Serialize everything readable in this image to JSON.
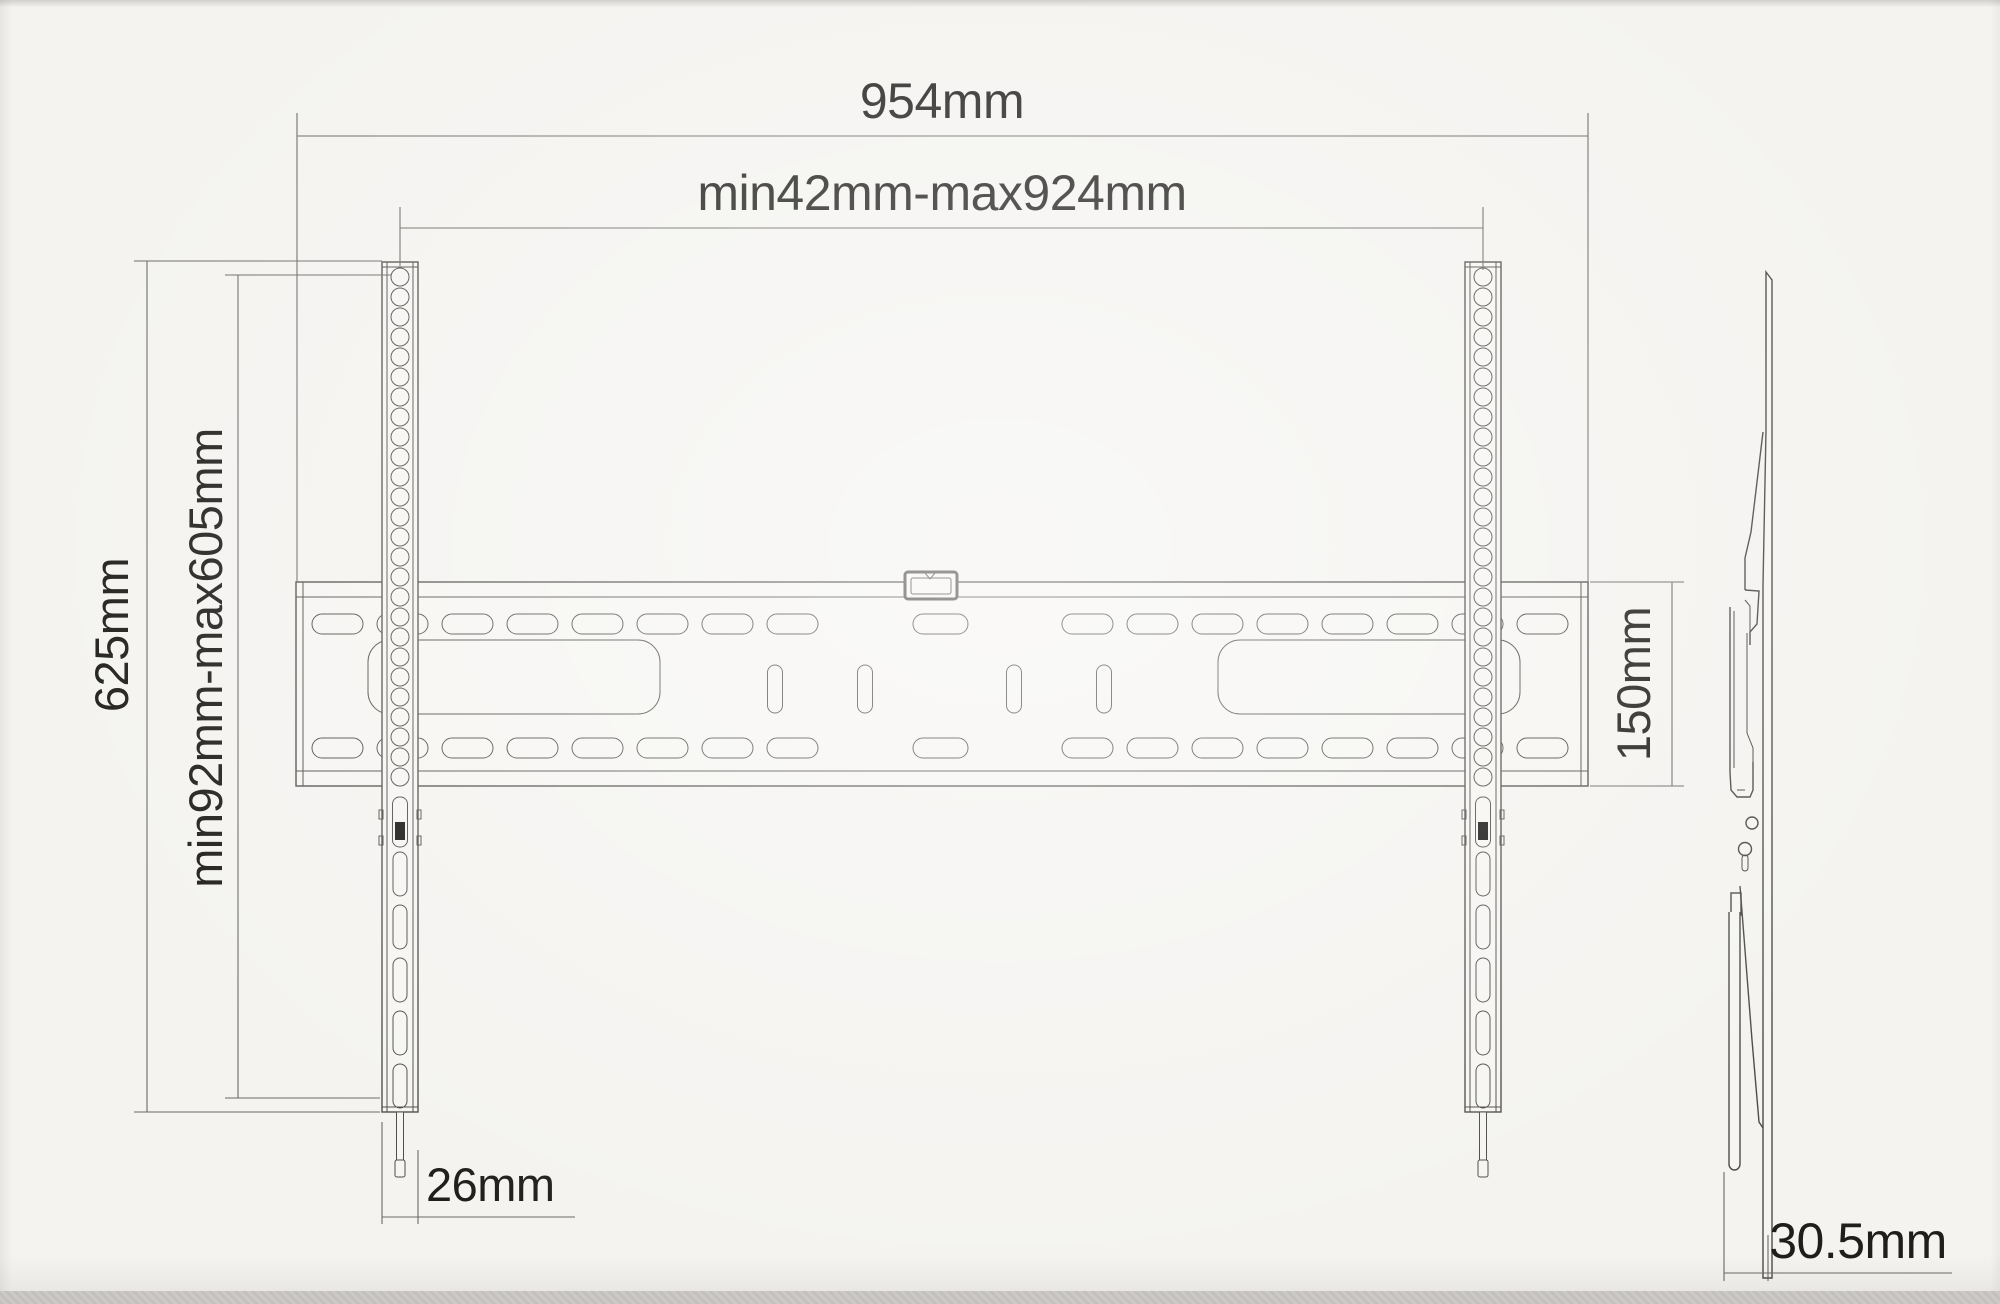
{
  "drawing": {
    "subject": "TV wall mount bracket dimensional drawing",
    "views": {
      "front": "front-view",
      "side": "side-view"
    }
  },
  "dimensions": {
    "overall_width": {
      "label": "954mm"
    },
    "mount_width_range": {
      "label": "min42mm-max924mm"
    },
    "rail_height": {
      "label": "625mm"
    },
    "mount_height_range": {
      "label": "min92mm-max605mm"
    },
    "plate_height": {
      "label": "150mm"
    },
    "rail_width": {
      "label": "26mm"
    },
    "profile_depth": {
      "label": "30.5mm"
    }
  },
  "colors": {
    "background": "#f4f3f0",
    "paper": "#f6f5f2",
    "line": "#4e4c49",
    "dimline": "#6b6965",
    "text": "#1f1e1c",
    "ink": "#141312"
  }
}
